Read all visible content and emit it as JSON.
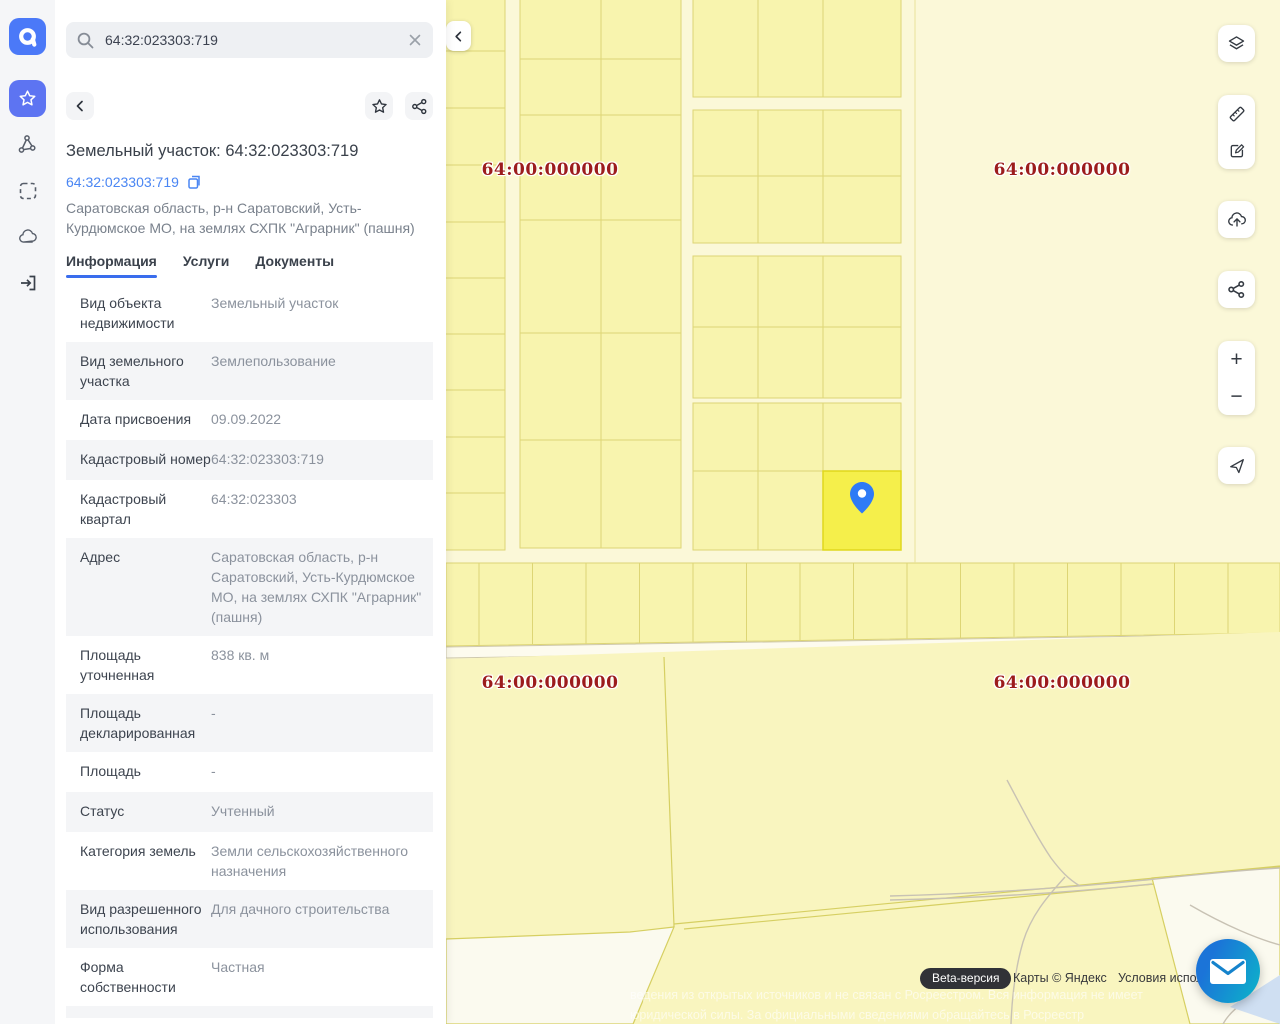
{
  "search": {
    "value": "64:32:023303:719"
  },
  "sidebar": {
    "icons": [
      "app-logo",
      "favorites-star-icon",
      "polygon-icon",
      "area-select-icon",
      "cloud-icon",
      "sign-in-icon"
    ]
  },
  "panel": {
    "title": "Земельный участок: 64:32:023303:719",
    "cad_link": "64:32:023303:719",
    "address": "Саратовская область, р-н Саратовский, Усть-Курдюмское МО, на землях СХПК \"Аграрник\" (пашня)",
    "tabs": [
      {
        "label": "Информация",
        "active": true
      },
      {
        "label": "Услуги",
        "active": false
      },
      {
        "label": "Документы",
        "active": false
      }
    ],
    "rows": [
      {
        "label": "Вид объекта недвижимости",
        "value": "Земельный участок"
      },
      {
        "label": "Вид земельного участка",
        "value": "Землепользование"
      },
      {
        "label": "Дата присвоения",
        "value": "09.09.2022"
      },
      {
        "label": "Кадастровый номер",
        "value": "64:32:023303:719"
      },
      {
        "label": "Кадастровый квартал",
        "value": "64:32:023303"
      },
      {
        "label": "Адрес",
        "value": "Саратовская область, р-н Саратовский, Усть-Курдюмское МО, на землях СХПК \"Аграрник\" (пашня)"
      },
      {
        "label": "Площадь уточненная",
        "value": "838 кв. м"
      },
      {
        "label": "Площадь декларированная",
        "value": "-"
      },
      {
        "label": "Площадь",
        "value": "-"
      },
      {
        "label": "Статус",
        "value": "Учтенный"
      },
      {
        "label": "Категория земель",
        "value": "Земли сельскохозяйственного назначения"
      },
      {
        "label": "Вид разрешенного использования",
        "value": "Для дачного строительства"
      },
      {
        "label": "Форма собственности",
        "value": "Частная"
      }
    ]
  },
  "map": {
    "quarter_labels": [
      {
        "text": "64:00:000000",
        "x": 104,
        "y": 170
      },
      {
        "text": "64:00:000000",
        "x": 616,
        "y": 170
      },
      {
        "text": "64:00:000000",
        "x": 104,
        "y": 683
      },
      {
        "text": "64:00:000000",
        "x": 616,
        "y": 683
      }
    ],
    "controls": {
      "zoom_in": "+",
      "zoom_out": "−",
      "icons": [
        "layers-icon",
        "ruler-icon",
        "edit-icon",
        "cloud-upload-icon",
        "share-icon",
        "locate-icon"
      ]
    },
    "attribution": {
      "beta_badge": "Beta-версия",
      "copyright": "Карты © Яндекс",
      "terms": "Условия использования"
    },
    "watermark_line1": "ведения из открытых источников и не связан с Росреестром. Вся информация не имеет",
    "watermark_line2": "юридической силы. За официальными сведениями обращайтесь в Росреестр",
    "colors": {
      "parcel_fill": "#f8f4ae",
      "parcel_stroke": "#ddd575",
      "selected_parcel_fill": "#f5ef4b",
      "selected_parcel_stroke": "#e0d71d",
      "quarter_label": "#9c1c1c",
      "pin": "#2e7bf6",
      "accent_blue": "#4a86f3"
    }
  }
}
